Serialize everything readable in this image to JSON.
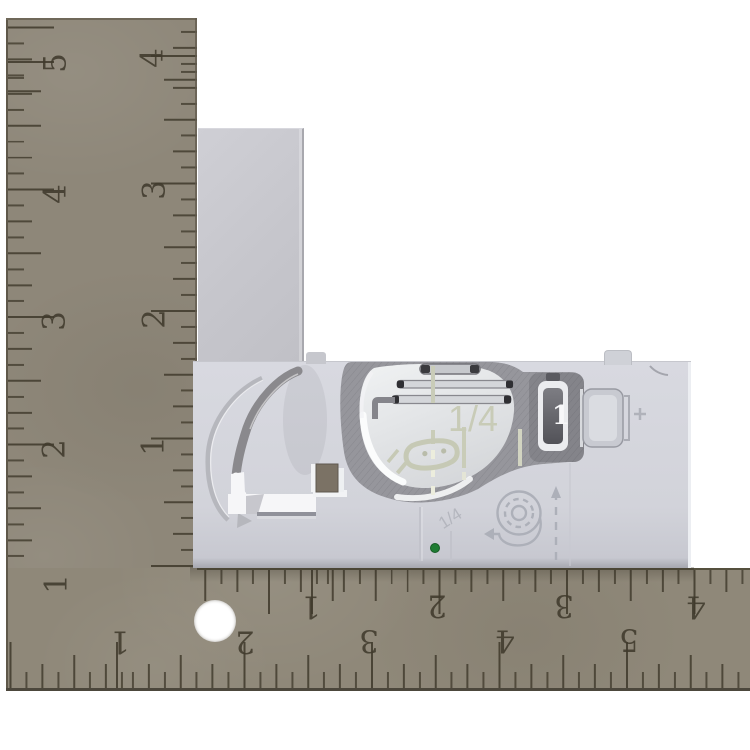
{
  "scene": {
    "background_color": "#ffffff",
    "subject": "needle plate cover measured with L-square ruler"
  },
  "ruler": {
    "kind": "L-square",
    "unit": "inches",
    "body_color": "#8e8779",
    "tick_color": "#4f4937",
    "hole_color": "#ffffff",
    "scales": {
      "vertical_outer": [
        "5",
        "4",
        "3",
        "2",
        "1"
      ],
      "vertical_inner": [
        "4",
        "3",
        "2",
        "1"
      ],
      "horizontal_inner": [
        "1",
        "2",
        "3",
        "4"
      ],
      "horizontal_outer": [
        "1",
        "2",
        "3",
        "4",
        "5"
      ]
    }
  },
  "plate": {
    "body_color": "#d2d3da",
    "top_arm_color": "#c6c6cc",
    "window_color": "#e9ebec",
    "frame_color": "#96969c",
    "guide_line_color": "#c9ccb8",
    "green_dot_color": "#1f7c33",
    "square_hole_color": "#7b7265",
    "markings": {
      "quarter_label": "1/4",
      "quarter_small_label": "1/4",
      "latch_number": "1"
    },
    "icons": [
      "curved-arrow-icon",
      "bobbin-thread-icon",
      "up-arrow-dashed-icon",
      "left-arrow-icon"
    ]
  }
}
